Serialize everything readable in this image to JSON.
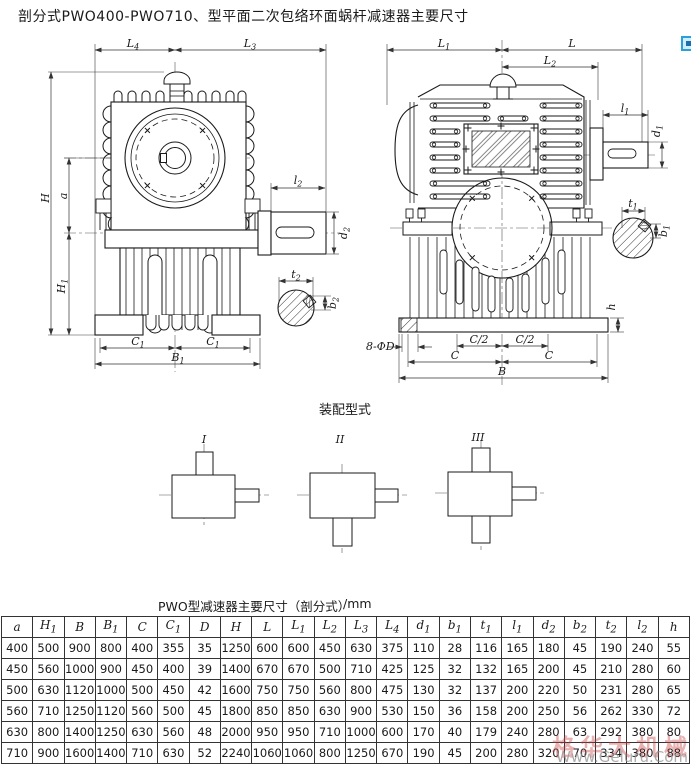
{
  "page": {
    "title": "剖分式PWO400-PWO710、型平面二次包络环面蜗杆减速器主要尺寸"
  },
  "drawings": {
    "front": {
      "L4": "L_4",
      "L3": "L_3",
      "l2": "l_2",
      "H": "H",
      "a": "a",
      "H1": "H_1",
      "d2": "d_2",
      "t2": "t_2",
      "b2": "b_2",
      "C1a": "C_1",
      "C1b": "C_1",
      "B1": "B_1"
    },
    "side": {
      "L1": "L_1",
      "L": "L",
      "L2": "L_2",
      "l1": "l_1",
      "d1": "d_1",
      "t1": "t_1",
      "b1": "b_1",
      "holes": "8-ΦD",
      "Ch1": "C/2",
      "Ch2": "C/2",
      "Ca": "C",
      "Cb": "C",
      "B": "B",
      "h": "h"
    }
  },
  "assembly": {
    "title": "装配型式",
    "types": [
      "I",
      "II",
      "III"
    ]
  },
  "table": {
    "title": "PWO型减速器主要尺寸（剖分式）",
    "unit": "/mm",
    "columns": [
      "a",
      "H_1",
      "B",
      "B_1",
      "C",
      "C_1",
      "D",
      "H",
      "L",
      "L_1",
      "L_2",
      "L_3",
      "L_4",
      "d_1",
      "b_1",
      "t_1",
      "l_1",
      "d_2",
      "b_2",
      "t_2",
      "l_2",
      "h"
    ],
    "rows": [
      [
        400,
        500,
        900,
        800,
        400,
        355,
        35,
        1250,
        600,
        600,
        450,
        630,
        375,
        110,
        28,
        116,
        165,
        180,
        45,
        190,
        240,
        55
      ],
      [
        450,
        560,
        1000,
        900,
        450,
        400,
        39,
        1400,
        670,
        670,
        500,
        710,
        425,
        125,
        32,
        132,
        165,
        200,
        45,
        210,
        280,
        60
      ],
      [
        500,
        630,
        1120,
        1000,
        500,
        450,
        42,
        1600,
        750,
        750,
        560,
        800,
        475,
        130,
        32,
        137,
        200,
        220,
        50,
        231,
        280,
        65
      ],
      [
        560,
        710,
        1250,
        1120,
        560,
        500,
        45,
        1800,
        850,
        850,
        630,
        900,
        530,
        150,
        36,
        158,
        200,
        250,
        56,
        262,
        330,
        72
      ],
      [
        630,
        800,
        1400,
        1250,
        630,
        560,
        48,
        2000,
        950,
        950,
        710,
        1000,
        600,
        170,
        40,
        179,
        240,
        280,
        63,
        292,
        380,
        80
      ],
      [
        710,
        900,
        1600,
        1400,
        710,
        630,
        52,
        2240,
        1060,
        1060,
        800,
        1250,
        670,
        190,
        45,
        200,
        280,
        320,
        70,
        334,
        380,
        88
      ]
    ]
  },
  "watermark": {
    "stamp": "格华大机械",
    "site": "Www.Geluru.Com"
  },
  "colors": {
    "line": "#1a1a1a",
    "accent_icon_blue": "#2d9fd8",
    "watermark_red": "#c53e3e"
  }
}
